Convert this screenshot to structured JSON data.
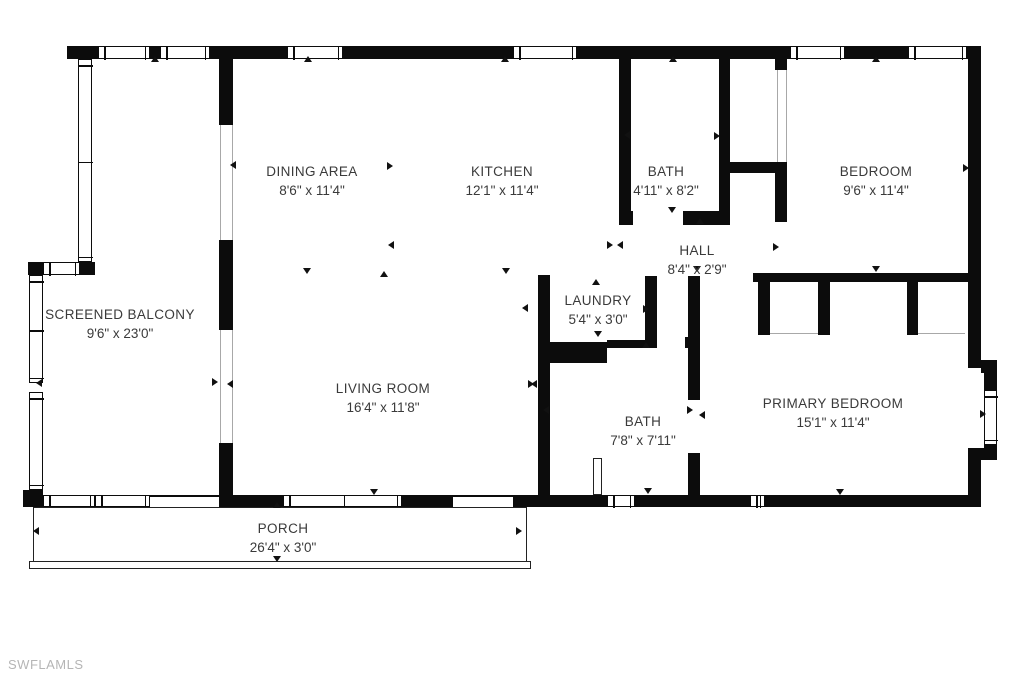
{
  "watermark": "SWFLAMLS",
  "floorplan": {
    "wall_color": "#0c0c0c",
    "text_color": "#3a3a3a",
    "watermark_color": "#b5b5b5",
    "rooms": [
      {
        "name": "DINING AREA",
        "dims": "8'6\" x 11'4\"",
        "cx": 312,
        "cy": 181
      },
      {
        "name": "KITCHEN",
        "dims": "12'1\" x 11'4\"",
        "cx": 502,
        "cy": 181
      },
      {
        "name": "BATH",
        "dims": "4'11\" x 8'2\"",
        "cx": 666,
        "cy": 181
      },
      {
        "name": "BEDROOM",
        "dims": "9'6\" x 11'4\"",
        "cx": 876,
        "cy": 181
      },
      {
        "name": "HALL",
        "dims": "8'4\" x 2'9\"",
        "cx": 697,
        "cy": 260
      },
      {
        "name": "LAUNDRY",
        "dims": "5'4\" x 3'0\"",
        "cx": 598,
        "cy": 310
      },
      {
        "name": "SCREENED BALCONY",
        "dims": "9'6\" x 23'0\"",
        "cx": 120,
        "cy": 324
      },
      {
        "name": "LIVING ROOM",
        "dims": "16'4\" x 11'8\"",
        "cx": 383,
        "cy": 398
      },
      {
        "name": "BATH",
        "dims": "7'8\" x 7'11\"",
        "cx": 643,
        "cy": 431
      },
      {
        "name": "PRIMARY BEDROOM",
        "dims": "15'1\" x 11'4\"",
        "cx": 833,
        "cy": 413
      },
      {
        "name": "PORCH",
        "dims": "26'4\" x 3'0\"",
        "cx": 283,
        "cy": 538
      }
    ],
    "walls": [
      [
        67,
        46,
        31,
        13
      ],
      [
        150,
        46,
        10,
        13
      ],
      [
        210,
        46,
        77,
        13
      ],
      [
        343,
        46,
        170,
        13
      ],
      [
        577,
        46,
        213,
        13
      ],
      [
        845,
        46,
        63,
        13
      ],
      [
        967,
        46,
        14,
        13
      ],
      [
        968,
        46,
        13,
        322
      ],
      [
        981,
        360,
        16,
        13
      ],
      [
        984,
        371,
        13,
        20
      ],
      [
        984,
        443,
        13,
        17
      ],
      [
        968,
        448,
        29,
        12
      ],
      [
        968,
        458,
        13,
        49
      ],
      [
        23,
        490,
        20,
        17
      ],
      [
        219,
        495,
        64,
        12
      ],
      [
        402,
        495,
        51,
        12
      ],
      [
        513,
        495,
        94,
        12
      ],
      [
        635,
        495,
        115,
        12
      ],
      [
        765,
        495,
        216,
        12
      ],
      [
        28,
        262,
        15,
        13
      ],
      [
        80,
        262,
        15,
        13
      ],
      [
        219,
        59,
        14,
        66
      ],
      [
        219,
        240,
        14,
        90
      ],
      [
        219,
        443,
        14,
        52
      ],
      [
        619,
        59,
        12,
        152
      ],
      [
        619,
        211,
        14,
        14
      ],
      [
        719,
        59,
        11,
        166
      ],
      [
        683,
        211,
        47,
        14
      ],
      [
        730,
        162,
        57,
        11
      ],
      [
        775,
        162,
        12,
        60
      ],
      [
        775,
        59,
        12,
        11
      ],
      [
        753,
        273,
        224,
        9
      ],
      [
        758,
        282,
        12,
        53
      ],
      [
        818,
        282,
        12,
        53
      ],
      [
        907,
        282,
        11,
        53
      ],
      [
        538,
        275,
        12,
        220
      ],
      [
        550,
        342,
        57,
        21
      ],
      [
        645,
        276,
        12,
        67
      ],
      [
        607,
        340,
        50,
        8
      ],
      [
        685,
        337,
        15,
        11
      ],
      [
        688,
        276,
        12,
        124
      ],
      [
        688,
        453,
        12,
        42
      ]
    ],
    "windows": [
      {
        "x": 98,
        "y": 46,
        "w": 52,
        "h": 13,
        "o": "h"
      },
      {
        "x": 160,
        "y": 46,
        "w": 50,
        "h": 13,
        "o": "h"
      },
      {
        "x": 287,
        "y": 46,
        "w": 56,
        "h": 13,
        "o": "h"
      },
      {
        "x": 513,
        "y": 46,
        "w": 64,
        "h": 13,
        "o": "h"
      },
      {
        "x": 790,
        "y": 46,
        "w": 55,
        "h": 13,
        "o": "h"
      },
      {
        "x": 908,
        "y": 46,
        "w": 59,
        "h": 13,
        "o": "h"
      },
      {
        "x": 78,
        "y": 59,
        "w": 14,
        "h": 203,
        "o": "v"
      },
      {
        "x": 43,
        "y": 262,
        "w": 37,
        "h": 13,
        "o": "h"
      },
      {
        "x": 29,
        "y": 275,
        "w": 14,
        "h": 108,
        "o": "v"
      },
      {
        "x": 29,
        "y": 392,
        "w": 14,
        "h": 98,
        "o": "v"
      },
      {
        "x": 43,
        "y": 495,
        "w": 52,
        "h": 12,
        "o": "h"
      },
      {
        "x": 95,
        "y": 495,
        "w": 55,
        "h": 12,
        "o": "h"
      },
      {
        "x": 283,
        "y": 495,
        "w": 119,
        "h": 12,
        "o": "h"
      },
      {
        "x": 607,
        "y": 495,
        "w": 28,
        "h": 12,
        "o": "h"
      },
      {
        "x": 750,
        "y": 495,
        "w": 15,
        "h": 12,
        "o": "h"
      },
      {
        "x": 984,
        "y": 390,
        "w": 13,
        "h": 55,
        "o": "v"
      }
    ],
    "open_lines": [
      [
        220,
        125,
        1,
        115
      ],
      [
        232,
        125,
        1,
        115
      ],
      [
        220,
        330,
        1,
        113
      ],
      [
        232,
        330,
        1,
        113
      ],
      [
        777,
        70,
        1,
        92
      ],
      [
        786,
        70,
        1,
        92
      ],
      [
        770,
        333,
        48,
        1
      ],
      [
        918,
        333,
        47,
        1
      ]
    ],
    "thin_lines": [
      [
        150,
        495,
        69,
        2
      ],
      [
        453,
        495,
        60,
        2
      ]
    ],
    "porch_outline": [
      33,
      507,
      494,
      55
    ],
    "porch_band": [
      29,
      561,
      502,
      8
    ],
    "door_panels": [
      [
        593,
        458,
        9,
        37
      ]
    ],
    "arrows": [
      {
        "x": 155,
        "y": 60,
        "d": "up"
      },
      {
        "x": 308,
        "y": 60,
        "d": "up"
      },
      {
        "x": 505,
        "y": 60,
        "d": "up"
      },
      {
        "x": 673,
        "y": 60,
        "d": "up"
      },
      {
        "x": 876,
        "y": 60,
        "d": "up"
      },
      {
        "x": 384,
        "y": 275,
        "d": "up"
      },
      {
        "x": 596,
        "y": 283,
        "d": "up"
      },
      {
        "x": 646,
        "y": 346,
        "d": "up"
      },
      {
        "x": 700,
        "y": 222,
        "d": "up"
      },
      {
        "x": 277,
        "y": 506,
        "d": "up"
      },
      {
        "x": 307,
        "y": 272,
        "d": "down"
      },
      {
        "x": 506,
        "y": 272,
        "d": "down"
      },
      {
        "x": 876,
        "y": 270,
        "d": "down"
      },
      {
        "x": 672,
        "y": 211,
        "d": "down"
      },
      {
        "x": 697,
        "y": 270,
        "d": "down"
      },
      {
        "x": 598,
        "y": 335,
        "d": "down"
      },
      {
        "x": 648,
        "y": 492,
        "d": "down"
      },
      {
        "x": 840,
        "y": 493,
        "d": "down"
      },
      {
        "x": 374,
        "y": 493,
        "d": "down"
      },
      {
        "x": 277,
        "y": 560,
        "d": "down"
      },
      {
        "x": 234,
        "y": 165,
        "d": "left"
      },
      {
        "x": 392,
        "y": 245,
        "d": "left"
      },
      {
        "x": 621,
        "y": 245,
        "d": "left"
      },
      {
        "x": 628,
        "y": 135,
        "d": "left"
      },
      {
        "x": 526,
        "y": 308,
        "d": "left"
      },
      {
        "x": 40,
        "y": 383,
        "d": "left"
      },
      {
        "x": 231,
        "y": 384,
        "d": "left"
      },
      {
        "x": 547,
        "y": 410,
        "d": "left"
      },
      {
        "x": 703,
        "y": 415,
        "d": "left"
      },
      {
        "x": 535,
        "y": 384,
        "d": "left"
      },
      {
        "x": 37,
        "y": 531,
        "d": "left"
      },
      {
        "x": 391,
        "y": 166,
        "d": "right"
      },
      {
        "x": 718,
        "y": 136,
        "d": "right"
      },
      {
        "x": 777,
        "y": 247,
        "d": "right"
      },
      {
        "x": 967,
        "y": 168,
        "d": "right"
      },
      {
        "x": 216,
        "y": 382,
        "d": "right"
      },
      {
        "x": 532,
        "y": 384,
        "d": "right"
      },
      {
        "x": 691,
        "y": 410,
        "d": "right"
      },
      {
        "x": 984,
        "y": 414,
        "d": "right"
      },
      {
        "x": 647,
        "y": 309,
        "d": "right"
      },
      {
        "x": 520,
        "y": 531,
        "d": "right"
      },
      {
        "x": 611,
        "y": 245,
        "d": "right"
      }
    ]
  }
}
